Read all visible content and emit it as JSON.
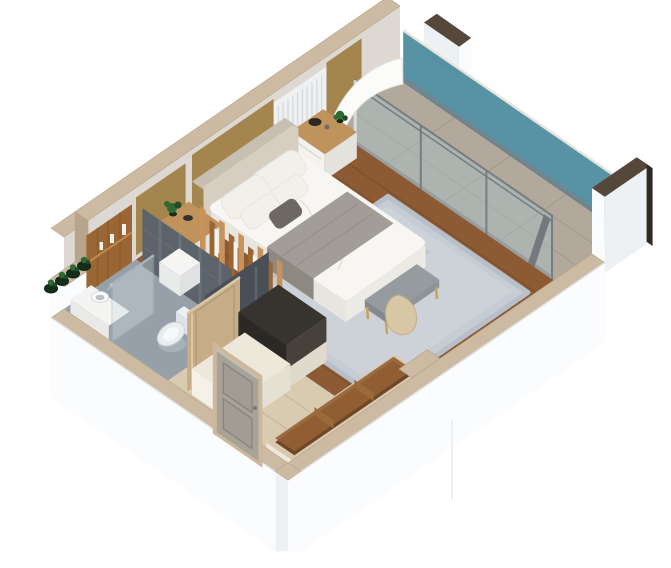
{
  "scene": {
    "label": "3D isometric cutaway floor plan of a studio hotel bedroom suite with balcony, bathroom and entry hall",
    "rooms": [
      {
        "name": "bedroom",
        "floor": "walnut plank",
        "features": [
          "double bed",
          "area rug",
          "nightstands",
          "foot bench"
        ]
      },
      {
        "name": "balcony",
        "floor": "stone tile",
        "features": [
          "teal glass railing",
          "sliding glass doors"
        ]
      },
      {
        "name": "bathroom",
        "floor": "gray tile",
        "features": [
          "round basin vanity",
          "toilet",
          "glass shower screen",
          "slate feature wall"
        ]
      },
      {
        "name": "entry-hall",
        "floor": "light stone",
        "features": [
          "paneled entry door",
          "open bathroom door",
          "charcoal cabinet",
          "wardrobe console"
        ]
      }
    ],
    "furniture": [
      "headboard",
      "duvet",
      "gray-blanket",
      "pillows",
      "foot-bench",
      "throw-blanket",
      "nightstand-left",
      "nightstand-right",
      "oak-slat-partition",
      "wardrobe-shelf",
      "storage-cube",
      "console-trough",
      "plants"
    ]
  },
  "colors": {
    "wallWhite": "#fbfcfd",
    "wallShade": "#eef1f3",
    "wallFace": "#ddd8d1",
    "capTan": "#cdbaa2",
    "capEdge": "#b7a48c",
    "darkCap": "#55483a",
    "darkEdge": "#2f2a24",
    "balconyFloor": "#b2a99c",
    "balconyLine": "#a1988b",
    "tealGlass": "#3b7f95",
    "tealLight": "#7db4c0",
    "sliderGlass": "#a7c1cb",
    "frameGray": "#767d81",
    "woodFloor": "#8c5a33",
    "woodLine": "#744a2a",
    "corridorWood": "#d8cbb0",
    "corridorLine": "#c0ae8e",
    "bathFloor": "#97a0a9",
    "rug": "#c6ccd3",
    "rugEdge": "#b8bfc8",
    "rugLight": "#d3d8de",
    "bronze": "#a5854e",
    "slatWhite": "#eef0f2",
    "slatLine": "#d8dce0",
    "cream": "#d6cfc1",
    "creamDark": "#c7bfb0",
    "duvet": "#f7f6f2",
    "duvetShade": "#e7e5df",
    "pillow": "#f2f0ea",
    "pillowGray": "#6e6862",
    "blanket": "#a29e97",
    "blanketDark": "#8d8981",
    "woodTop": "#c0925c",
    "oakLight": "#c8935a",
    "oakDark": "#9a6734",
    "slate": "#5c636b",
    "slateDark": "#494f56",
    "slateStreak": "#7a828b",
    "charcoal": "#37332e",
    "charcoalDark": "#2b2825",
    "charcoalSide": "#46413a",
    "creamCab": "#eee8db",
    "porcelain": "#e9edf0",
    "porcelainShade": "#ccd4da",
    "chrome": "#aab3b9",
    "plantGreen": "#2e6b34",
    "plantDark": "#1e4a25",
    "potDark": "#142e1a",
    "doorGray": "#a8a399",
    "doorLine": "#8b867c",
    "doorFrame": "#ccb89d",
    "beigeDoor": "#c6ad88",
    "beigeDoorLight": "#dcc7a4",
    "benchSeat": "#969ba0",
    "gold": "#c9a25e",
    "curtainGray": "#75797d",
    "throwTan": "#d8c7a4",
    "throwTanDark": "#c3b08b"
  }
}
